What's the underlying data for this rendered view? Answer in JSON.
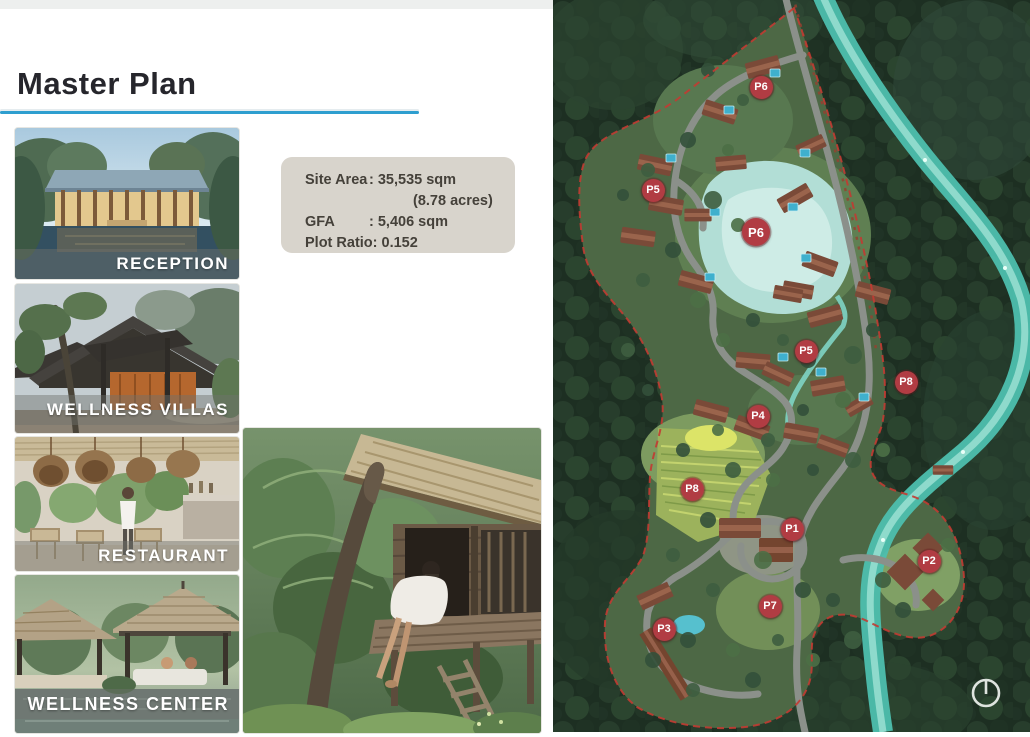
{
  "title": "Master Plan",
  "info_box": {
    "rows": [
      {
        "label": "Site Area",
        "value": ": 35,535 sqm"
      },
      {
        "label": "",
        "value": "(8.78 acres)"
      },
      {
        "label": "GFA",
        "value": ": 5,406 sqm"
      },
      {
        "label": "Plot Ratio:",
        "value": " 0.152"
      }
    ]
  },
  "photos": [
    {
      "label": "RECEPTION"
    },
    {
      "label": "WELLNESS VILLAS"
    },
    {
      "label": "RESTAURANT"
    },
    {
      "label": "WELLNESS CENTER"
    }
  ],
  "map": {
    "marker_color": "#b13c43",
    "markers": [
      {
        "label": "P6",
        "x": 208,
        "y": 87
      },
      {
        "label": "P5",
        "x": 100,
        "y": 190
      },
      {
        "label": "P6",
        "x": 203,
        "y": 232,
        "size": 28
      },
      {
        "label": "P5",
        "x": 253,
        "y": 351
      },
      {
        "label": "P8",
        "x": 353,
        "y": 382
      },
      {
        "label": "P4",
        "x": 205,
        "y": 416
      },
      {
        "label": "P8",
        "x": 139,
        "y": 489
      },
      {
        "label": "P1",
        "x": 239,
        "y": 529
      },
      {
        "label": "P2",
        "x": 376,
        "y": 561
      },
      {
        "label": "P7",
        "x": 217,
        "y": 606
      },
      {
        "label": "P3",
        "x": 111,
        "y": 629
      }
    ]
  }
}
